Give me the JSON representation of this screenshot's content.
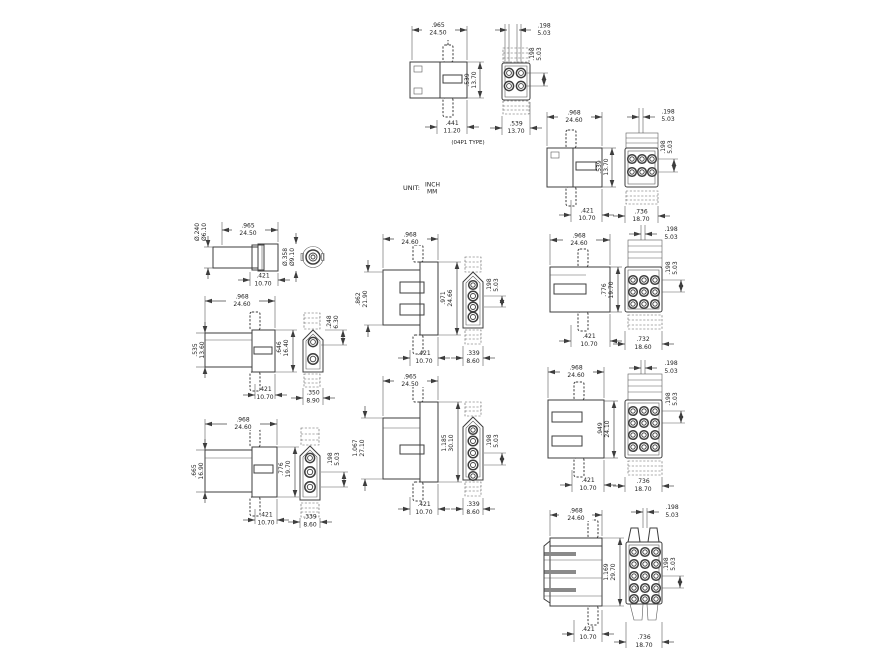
{
  "unit": {
    "label": "UNIT:",
    "inch": "INCH",
    "mm": "MM"
  },
  "note": "(04P1 TYPE)",
  "colors": {
    "line": "#3d3d3d",
    "stripe_gray": "#8a8a8a",
    "background": "#ffffff"
  },
  "groups": {
    "p04": {
      "title": "4-position connector (04P1 type)",
      "pins": "2 x 2",
      "width": {
        "in": ".965",
        "mm": "24.50"
      },
      "height": {
        "in": ".539",
        "mm": "13.70"
      },
      "base": {
        "in": ".441",
        "mm": "11.20"
      },
      "pitch_top": {
        "in": ".198",
        "mm": "5.03"
      },
      "pitch_side": {
        "in": ".198",
        "mm": "5.03"
      },
      "face": {
        "in": ".539",
        "mm": "13.70"
      }
    },
    "p06": {
      "title": "6-position connector",
      "pins": "2 x 3",
      "width": {
        "in": ".968",
        "mm": "24.60"
      },
      "height": {
        "in": ".539",
        "mm": "13.70"
      },
      "base": {
        "in": ".421",
        "mm": "10.70"
      },
      "pitch_top": {
        "in": ".198",
        "mm": "5.03"
      },
      "pitch_side": {
        "in": ".198",
        "mm": "5.03"
      },
      "face": {
        "in": ".736",
        "mm": "18.70"
      }
    },
    "cap": {
      "title": "single-pole bullet receptacle",
      "pins": "1",
      "dia_small": {
        "in": "Ø.240",
        "mm": "Ø6.10"
      },
      "width": {
        "in": ".965",
        "mm": "24.50"
      },
      "base": {
        "in": ".421",
        "mm": "10.70"
      },
      "dia_large": {
        "in": "Ø.358",
        "mm": "Ø9.10"
      }
    },
    "p02": {
      "title": "2-position connector",
      "pins": "1 x 2",
      "width": {
        "in": ".968",
        "mm": "24.60"
      },
      "height_left": {
        "in": ".535",
        "mm": "13.60"
      },
      "height_right": {
        "in": ".646",
        "mm": "16.40"
      },
      "base": {
        "in": ".421",
        "mm": "10.70"
      },
      "pitch_side": {
        "in": ".248",
        "mm": "6.30"
      },
      "face": {
        "in": ".350",
        "mm": "8.90"
      }
    },
    "p03": {
      "title": "3-position connector",
      "pins": "1 x 3",
      "width": {
        "in": ".968",
        "mm": "24.60"
      },
      "height_left": {
        "in": ".665",
        "mm": "16.90"
      },
      "height_right": {
        "in": ".776",
        "mm": "19.70"
      },
      "base": {
        "in": ".421",
        "mm": "10.70"
      },
      "pitch_side": {
        "in": ".198",
        "mm": "5.03"
      },
      "face": {
        "in": ".339",
        "mm": "8.60"
      }
    },
    "p04v": {
      "title": "4-position inline connector",
      "pins": "1 x 4",
      "width": {
        "in": ".968",
        "mm": "24.60"
      },
      "height_left": {
        "in": ".862",
        "mm": "21.90"
      },
      "height_right": {
        "in": ".971",
        "mm": "24.66"
      },
      "base": {
        "in": ".421",
        "mm": "10.70"
      },
      "pitch_side": {
        "in": ".198",
        "mm": "5.03"
      },
      "face": {
        "in": ".339",
        "mm": "8.60"
      }
    },
    "p05v": {
      "title": "5-position inline connector",
      "pins": "1 x 5",
      "width": {
        "in": ".965",
        "mm": "24.50"
      },
      "height_left": {
        "in": "1.067",
        "mm": "27.10"
      },
      "height_right": {
        "in": "1.185",
        "mm": "30.10"
      },
      "base": {
        "in": ".421",
        "mm": "10.70"
      },
      "pitch_side": {
        "in": ".198",
        "mm": "5.03"
      },
      "face": {
        "in": ".339",
        "mm": "8.60"
      }
    },
    "p09": {
      "title": "9-position connector",
      "pins": "3 x 3",
      "width": {
        "in": ".968",
        "mm": "24.60"
      },
      "height": {
        "in": ".776",
        "mm": "19.70"
      },
      "base": {
        "in": ".421",
        "mm": "10.70"
      },
      "pitch_top": {
        "in": ".198",
        "mm": "5.03"
      },
      "pitch_side": {
        "in": ".198",
        "mm": "5.03"
      },
      "face": {
        "in": ".732",
        "mm": "18.60"
      }
    },
    "p12": {
      "title": "12-position connector",
      "pins": "4 x 3",
      "width": {
        "in": ".968",
        "mm": "24.60"
      },
      "height": {
        "in": ".949",
        "mm": "24.10"
      },
      "base": {
        "in": ".421",
        "mm": "10.70"
      },
      "pitch_top": {
        "in": ".198",
        "mm": "5.03"
      },
      "pitch_side": {
        "in": ".198",
        "mm": "5.03"
      },
      "face": {
        "in": ".736",
        "mm": "18.70"
      }
    },
    "p15": {
      "title": "15-position connector",
      "pins": "5 x 3",
      "width": {
        "in": ".968",
        "mm": "24.60"
      },
      "height": {
        "in": "1.169",
        "mm": "29.70"
      },
      "base": {
        "in": ".421",
        "mm": "10.70"
      },
      "pitch_top": {
        "in": ".198",
        "mm": "5.03"
      },
      "pitch_side": {
        "in": ".198",
        "mm": "5.03"
      },
      "face": {
        "in": ".736",
        "mm": "18.70"
      }
    }
  }
}
